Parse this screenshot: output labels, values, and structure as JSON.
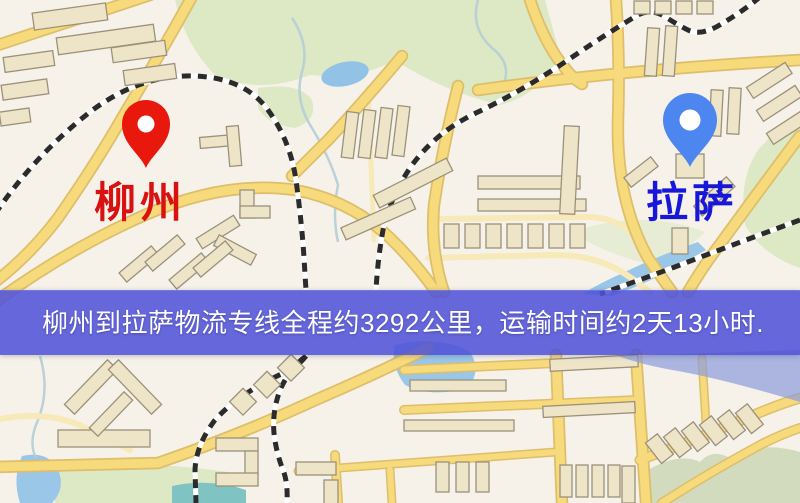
{
  "banner": {
    "text": "柳州到拉萨物流专线全程约3292公里，运输时间约2天13小时.",
    "background_color": "rgba(79,81,216,0.87)",
    "text_color": "#ffffff"
  },
  "origin": {
    "name": "柳州",
    "pin_icon": "red-location-pin",
    "pin_color": "#e8180c",
    "label_color": "#da1111"
  },
  "destination": {
    "name": "拉萨",
    "pin_icon": "blue-location-pin",
    "pin_color": "#4e86f0",
    "label_color": "#1617d8"
  },
  "route": {
    "distance_km": "3292",
    "duration": "2天13小时"
  },
  "map": {
    "colors": {
      "background": "#f6f2ea",
      "park": "#dde8c5",
      "park_dark": "#d2dbbe",
      "water": "#9ac6e8",
      "water_teal": "#7fc4c2",
      "water_band": "#8d9ddd",
      "stream": "#b5cdd6",
      "road_casing": "#ddbe6a",
      "road_fill": "#f7da7c",
      "road_minor": "#f7e9b8",
      "railway_dash": "#2b2b2b",
      "railway_base": "#ffffff",
      "building_fill": "#eee5c8",
      "building_outline": "#9b917b"
    }
  }
}
